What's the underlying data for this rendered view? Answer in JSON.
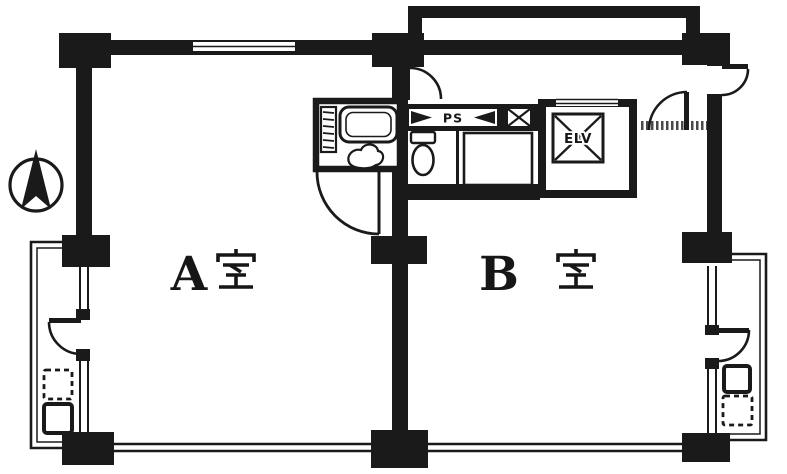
{
  "page": {
    "background_color": "#ffffff",
    "ink_color": "#1a1a1a"
  },
  "floor_plan": {
    "units": [
      {
        "label": "A 室",
        "letter": "A",
        "kanji": "室"
      },
      {
        "label": "B 室",
        "letter": "B",
        "kanji": "室"
      }
    ],
    "labels": {
      "pipe_space": "PS",
      "elevator": "ELV"
    },
    "compass": {
      "icon": "north-arrow"
    }
  }
}
